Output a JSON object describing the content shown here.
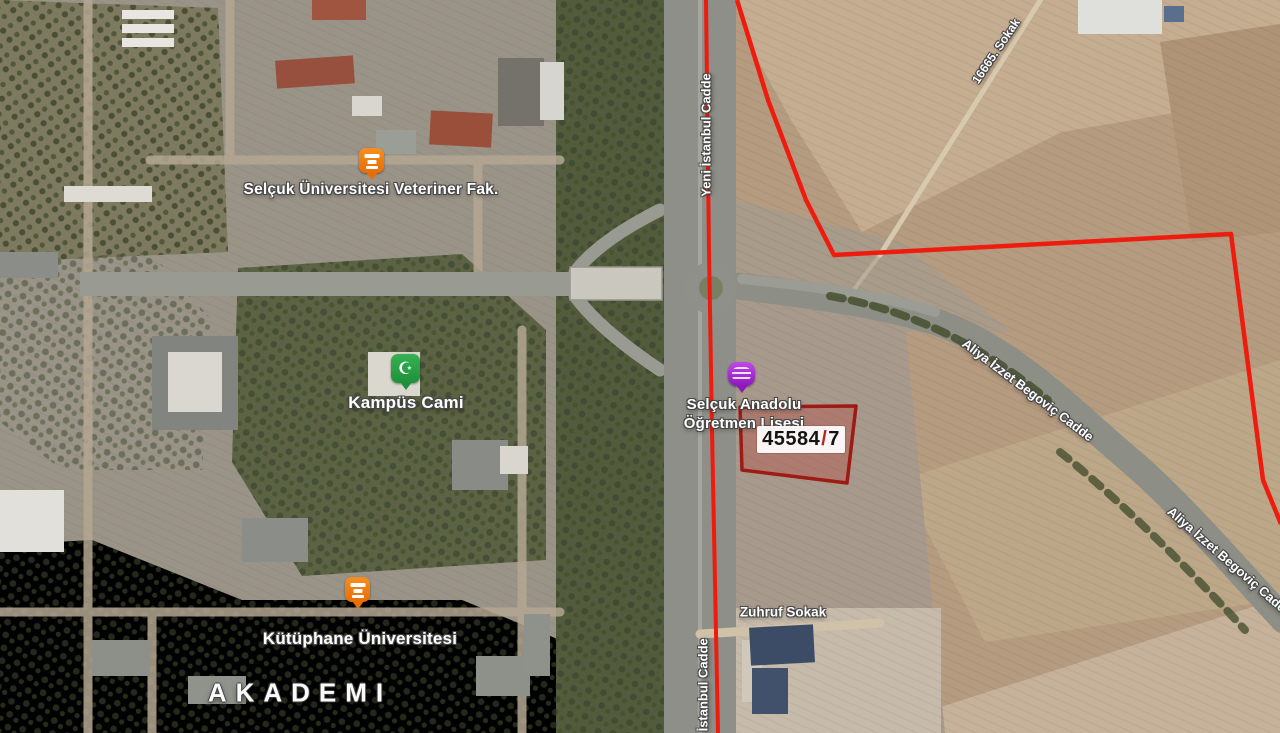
{
  "map": {
    "pois": [
      {
        "name": "Selçuk Üniversitesi Veteriner Fak.",
        "icon": "university-icon",
        "marker_color": "#e86d06"
      },
      {
        "name": "Kampüs Cami",
        "icon": "mosque-icon",
        "glyph": "☪",
        "marker_color": "#1d9138"
      },
      {
        "name": "Kütüphane Üniversitesi",
        "icon": "university-icon",
        "marker_color": "#e86d06"
      },
      {
        "line1": "Selçuk Anadolu",
        "line2": "Öğretmen Lisesi",
        "icon": "school-icon",
        "marker_color": "#8f17bd"
      }
    ],
    "road_labels": {
      "yeni_istanbul_top": "Yeni İstanbul Cadde",
      "yeni_istanbul_bottom": "Yeni İstanbul Cadde",
      "sokak_16665": "16665. Sokak",
      "aliya_1": "Aliya İzzet Begoviç Cadde",
      "aliya_2": "Aliya İzzet Begoviç Cadde",
      "zuhruf": "Zuhruf Sokak"
    },
    "district_label": "AKADEMI",
    "parcel": {
      "full": "45584/7",
      "block": "45584",
      "separator": "/",
      "lot": "7"
    },
    "colors": {
      "boundary_red": "#ee1c0f",
      "parcel_border": "#9e1a15",
      "parcel_fill": "rgba(190,55,50,0.30)",
      "label_text": "#ffffff"
    }
  }
}
